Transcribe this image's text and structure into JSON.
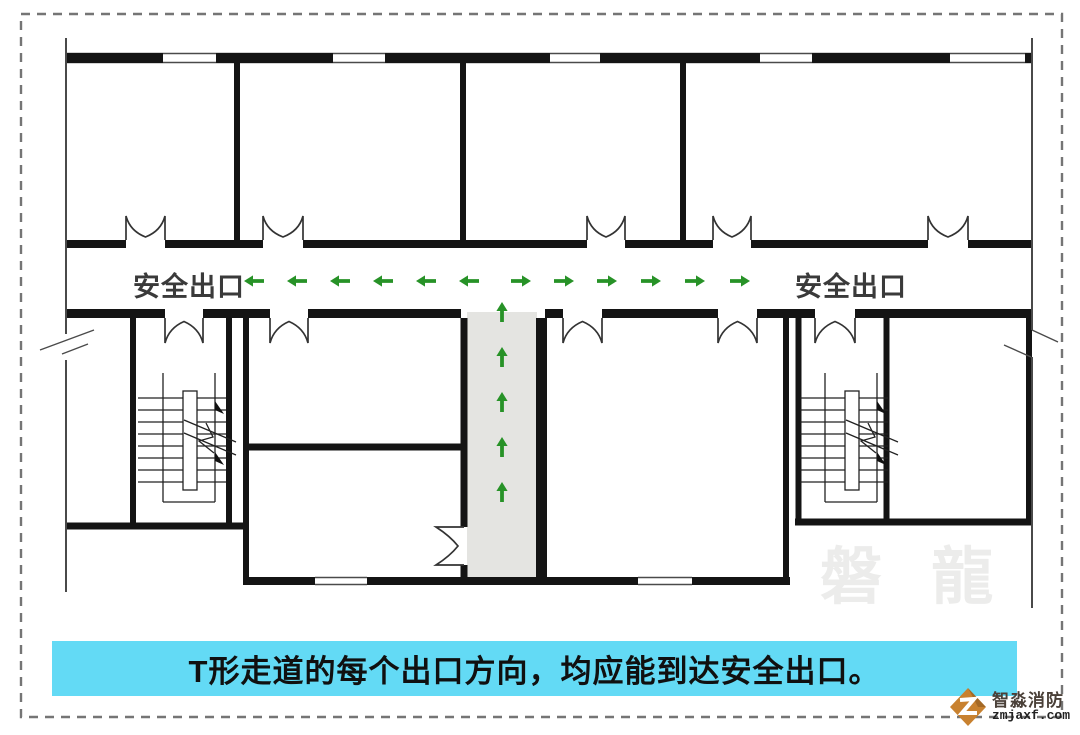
{
  "diagram": {
    "exit_label_left": "安全出口",
    "exit_label_right": "安全出口",
    "caption": "T形走道的每个出口方向，均应能到达安全出口。",
    "watermark": "磐 龍"
  },
  "logo": {
    "name": "智淼消防",
    "site": "zmjaxf.com"
  },
  "arrows": {
    "y": 281,
    "left": {
      "centers": [
        254,
        297,
        340,
        383,
        426,
        469
      ]
    },
    "right": {
      "centers": [
        521,
        564,
        607,
        651,
        695,
        740
      ]
    },
    "up": {
      "x": 502,
      "centers": [
        312,
        357,
        402,
        447,
        492
      ]
    }
  },
  "colors": {
    "arrow_green": "#279227",
    "caption_bg": "#63daf5",
    "caption_text": "#101010",
    "wall": "#141414",
    "thin_line": "#4a4a4a",
    "corridor_fill": "#e4e4e1",
    "frame_dash": "#757575",
    "label_text": "#3a3a3a",
    "watermark_text": "rgba(70,70,60,0.10)",
    "logo_orange": "#c8812f",
    "logo_name_text": "#4a4038",
    "logo_site_text": "#222222"
  }
}
